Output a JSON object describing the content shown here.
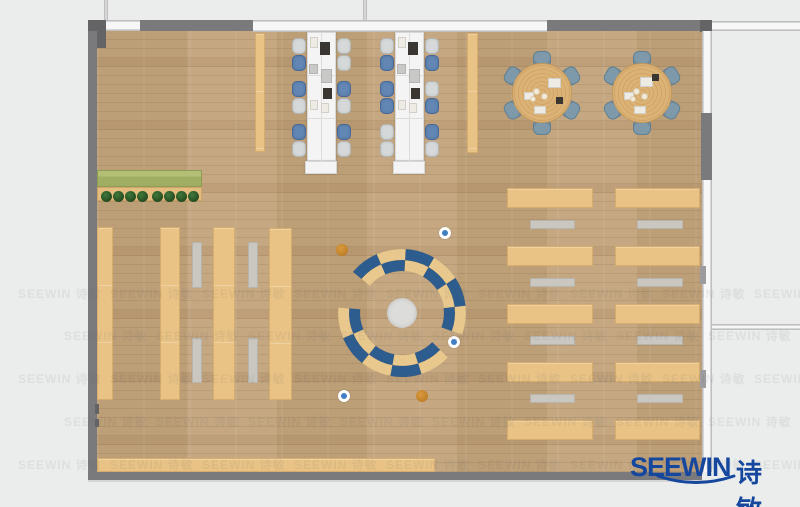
{
  "logo": {
    "en": "SEEWIN",
    "cn": "诗敏",
    "color": "#15479e"
  },
  "watermark": {
    "text": "SEEWIN 诗敏",
    "rows": [
      285,
      327,
      370,
      413,
      456
    ],
    "x_starts": [
      18,
      64
    ],
    "dx": 92,
    "x_max": 770
  },
  "palette": {
    "background": "#ebecec",
    "wall": "#7a7a7c",
    "wall_dark": "#646467",
    "floor_wood": "#c2a37b",
    "desk_white": "#f3f4f3",
    "chair_blue": "#6287b5",
    "chair_gray": "#d6d9d9",
    "seat_slate": "#7e99aa",
    "shelf_tan": "#e8c385",
    "bench_gray": "#cac7c1",
    "planter_green": "#9fae63",
    "tree_green": "#2f5c2f",
    "arc_blue": "#2d5d8e",
    "arc_tan": "#e8c88d",
    "stool_blue": "#3f80c2",
    "stool_orange": "#c8872b",
    "hub_gray": "#dcdcda"
  },
  "plan": {
    "canvas": {
      "w": 800,
      "h": 507
    },
    "rects": [
      {
        "x": 97,
        "y": 31,
        "w": 605,
        "h": 441,
        "t": "floor",
        "n": "wood-floor"
      },
      {
        "x": 255,
        "y": 33,
        "w": 10,
        "h": 119,
        "t": "shelf",
        "n": "side-strip-left"
      },
      {
        "x": 467,
        "y": 33,
        "w": 11,
        "h": 120,
        "t": "shelf",
        "n": "side-strip-right"
      },
      {
        "x": 307,
        "y": 32,
        "w": 29,
        "h": 129,
        "t": "desk",
        "n": "desk-bench-a"
      },
      {
        "x": 395,
        "y": 32,
        "w": 29,
        "h": 129,
        "t": "desk",
        "n": "desk-bench-b"
      },
      {
        "x": 305,
        "y": 161,
        "w": 32,
        "h": 13,
        "t": "desk",
        "n": "desk-return-a"
      },
      {
        "x": 393,
        "y": 161,
        "w": 32,
        "h": 13,
        "t": "desk",
        "n": "desk-return-b"
      },
      {
        "x": 321,
        "y": 32,
        "w": 1,
        "h": 129,
        "t": "desk-line",
        "n": "desk-divider"
      },
      {
        "x": 409,
        "y": 32,
        "w": 1,
        "h": 129,
        "t": "desk-line",
        "n": "desk-divider"
      },
      {
        "x": 307,
        "y": 75,
        "w": 29,
        "h": 1,
        "t": "desk-line",
        "n": "desk-divider"
      },
      {
        "x": 307,
        "y": 118,
        "w": 29,
        "h": 1,
        "t": "desk-line",
        "n": "desk-divider"
      },
      {
        "x": 395,
        "y": 75,
        "w": 29,
        "h": 1,
        "t": "desk-line",
        "n": "desk-divider"
      },
      {
        "x": 395,
        "y": 118,
        "w": 29,
        "h": 1,
        "t": "desk-line",
        "n": "desk-divider"
      },
      {
        "x": 310,
        "y": 37,
        "w": 8,
        "h": 11,
        "t": "paper",
        "n": "paper"
      },
      {
        "x": 320,
        "y": 42,
        "w": 10,
        "h": 13,
        "t": "laptop",
        "n": "laptop"
      },
      {
        "x": 309,
        "y": 64,
        "w": 9,
        "h": 10,
        "t": "panel",
        "n": "desk-panel"
      },
      {
        "x": 321,
        "y": 69,
        "w": 11,
        "h": 14,
        "t": "panel",
        "n": "desk-panel"
      },
      {
        "x": 323,
        "y": 88,
        "w": 9,
        "h": 11,
        "t": "laptop",
        "n": "laptop"
      },
      {
        "x": 310,
        "y": 100,
        "w": 8,
        "h": 10,
        "t": "paper",
        "n": "paper"
      },
      {
        "x": 321,
        "y": 103,
        "w": 8,
        "h": 10,
        "t": "paper",
        "n": "paper"
      },
      {
        "x": 398,
        "y": 37,
        "w": 8,
        "h": 11,
        "t": "paper",
        "n": "paper"
      },
      {
        "x": 408,
        "y": 42,
        "w": 10,
        "h": 13,
        "t": "laptop",
        "n": "laptop"
      },
      {
        "x": 397,
        "y": 64,
        "w": 9,
        "h": 10,
        "t": "panel",
        "n": "desk-panel"
      },
      {
        "x": 409,
        "y": 69,
        "w": 11,
        "h": 14,
        "t": "panel",
        "n": "desk-panel"
      },
      {
        "x": 411,
        "y": 88,
        "w": 9,
        "h": 11,
        "t": "laptop",
        "n": "laptop"
      },
      {
        "x": 398,
        "y": 100,
        "w": 8,
        "h": 10,
        "t": "paper",
        "n": "paper"
      },
      {
        "x": 409,
        "y": 103,
        "w": 8,
        "h": 10,
        "t": "paper",
        "n": "paper"
      },
      {
        "x": 97,
        "y": 170,
        "w": 105,
        "h": 17,
        "t": "planter",
        "n": "hedge-planter"
      },
      {
        "x": 97,
        "y": 187,
        "w": 105,
        "h": 14,
        "t": "planter-base",
        "n": "hedge-base"
      },
      {
        "x": 97,
        "y": 227,
        "w": 16,
        "h": 173,
        "t": "shelf",
        "n": "bookshelf-column-1"
      },
      {
        "x": 160,
        "y": 227,
        "w": 20,
        "h": 173,
        "t": "shelf",
        "n": "bookshelf-column-2"
      },
      {
        "x": 213,
        "y": 227,
        "w": 22,
        "h": 173,
        "t": "shelf",
        "n": "bookshelf-column-3"
      },
      {
        "x": 269,
        "y": 228,
        "w": 23,
        "h": 172,
        "t": "shelf",
        "n": "bookshelf-column-4"
      },
      {
        "x": 192,
        "y": 242,
        "w": 10,
        "h": 46,
        "t": "bench",
        "n": "bench-strip"
      },
      {
        "x": 192,
        "y": 338,
        "w": 10,
        "h": 45,
        "t": "bench",
        "n": "bench-strip"
      },
      {
        "x": 248,
        "y": 242,
        "w": 10,
        "h": 46,
        "t": "bench",
        "n": "bench-strip"
      },
      {
        "x": 248,
        "y": 338,
        "w": 10,
        "h": 45,
        "t": "bench",
        "n": "bench-strip"
      },
      {
        "x": 507,
        "y": 188,
        "w": 86,
        "h": 20,
        "t": "shelf",
        "n": "reading-row"
      },
      {
        "x": 507,
        "y": 246,
        "w": 86,
        "h": 20,
        "t": "shelf",
        "n": "reading-row"
      },
      {
        "x": 507,
        "y": 304,
        "w": 86,
        "h": 20,
        "t": "shelf",
        "n": "reading-row"
      },
      {
        "x": 507,
        "y": 362,
        "w": 86,
        "h": 20,
        "t": "shelf",
        "n": "reading-row"
      },
      {
        "x": 507,
        "y": 420,
        "w": 86,
        "h": 20,
        "t": "shelf",
        "n": "reading-row"
      },
      {
        "x": 615,
        "y": 188,
        "w": 85,
        "h": 20,
        "t": "shelf",
        "n": "reading-row"
      },
      {
        "x": 615,
        "y": 246,
        "w": 85,
        "h": 20,
        "t": "shelf",
        "n": "reading-row"
      },
      {
        "x": 615,
        "y": 304,
        "w": 85,
        "h": 20,
        "t": "shelf",
        "n": "reading-row"
      },
      {
        "x": 615,
        "y": 362,
        "w": 85,
        "h": 20,
        "t": "shelf",
        "n": "reading-row"
      },
      {
        "x": 615,
        "y": 420,
        "w": 85,
        "h": 20,
        "t": "shelf",
        "n": "reading-row"
      },
      {
        "x": 530,
        "y": 220,
        "w": 45,
        "h": 9,
        "t": "bench",
        "n": "bench-strip"
      },
      {
        "x": 530,
        "y": 278,
        "w": 45,
        "h": 9,
        "t": "bench",
        "n": "bench-strip"
      },
      {
        "x": 530,
        "y": 336,
        "w": 45,
        "h": 9,
        "t": "bench",
        "n": "bench-strip"
      },
      {
        "x": 530,
        "y": 394,
        "w": 45,
        "h": 9,
        "t": "bench",
        "n": "bench-strip"
      },
      {
        "x": 637,
        "y": 220,
        "w": 46,
        "h": 9,
        "t": "bench",
        "n": "bench-strip"
      },
      {
        "x": 637,
        "y": 278,
        "w": 46,
        "h": 9,
        "t": "bench",
        "n": "bench-strip"
      },
      {
        "x": 637,
        "y": 336,
        "w": 46,
        "h": 9,
        "t": "bench",
        "n": "bench-strip"
      },
      {
        "x": 637,
        "y": 394,
        "w": 46,
        "h": 9,
        "t": "bench",
        "n": "bench-strip"
      },
      {
        "x": 97,
        "y": 458,
        "w": 338,
        "h": 14,
        "t": "shelf",
        "n": "bottom-counter"
      },
      {
        "x": 548,
        "y": 78,
        "w": 13,
        "h": 10,
        "t": "paper",
        "n": "paper"
      },
      {
        "x": 524,
        "y": 92,
        "w": 10,
        "h": 8,
        "t": "paper",
        "n": "paper"
      },
      {
        "x": 534,
        "y": 106,
        "w": 12,
        "h": 8,
        "t": "paper",
        "n": "paper"
      },
      {
        "x": 556,
        "y": 97,
        "w": 7,
        "h": 7,
        "t": "laptop",
        "n": "tablet"
      },
      {
        "x": 640,
        "y": 77,
        "w": 13,
        "h": 10,
        "t": "paper",
        "n": "paper"
      },
      {
        "x": 624,
        "y": 92,
        "w": 10,
        "h": 8,
        "t": "paper",
        "n": "paper"
      },
      {
        "x": 634,
        "y": 106,
        "w": 12,
        "h": 8,
        "t": "paper",
        "n": "paper"
      },
      {
        "x": 652,
        "y": 74,
        "w": 7,
        "h": 7,
        "t": "laptop",
        "n": "tablet"
      },
      {
        "x": 104,
        "y": 0,
        "w": 4,
        "h": 21,
        "t": "window-v",
        "n": "exterior-wall-line"
      },
      {
        "x": 363,
        "y": 0,
        "w": 4,
        "h": 21,
        "t": "window-v",
        "n": "exterior-wall-line"
      },
      {
        "x": 88,
        "y": 20,
        "w": 18,
        "h": 28,
        "t": "wall-dark",
        "n": "corner-column-nw"
      },
      {
        "x": 106,
        "y": 20,
        "w": 34,
        "h": 11,
        "t": "window-h",
        "n": "window-top"
      },
      {
        "x": 140,
        "y": 20,
        "w": 113,
        "h": 11,
        "t": "wall",
        "n": "wall-top-left"
      },
      {
        "x": 253,
        "y": 20,
        "w": 294,
        "h": 12,
        "t": "window-h",
        "n": "window-top-main"
      },
      {
        "x": 547,
        "y": 20,
        "w": 155,
        "h": 11,
        "t": "wall",
        "n": "wall-top-right"
      },
      {
        "x": 700,
        "y": 20,
        "w": 12,
        "h": 12,
        "t": "wall-dark",
        "n": "corner-column-ne"
      },
      {
        "x": 712,
        "y": 21,
        "w": 88,
        "h": 10,
        "t": "window-h",
        "n": "exterior-window-band"
      },
      {
        "x": 88,
        "y": 31,
        "w": 9,
        "h": 449,
        "t": "wall",
        "n": "wall-left"
      },
      {
        "x": 95,
        "y": 404,
        "w": 4,
        "h": 10,
        "t": "wall-dark",
        "n": "wall-detail"
      },
      {
        "x": 95,
        "y": 419,
        "w": 4,
        "h": 8,
        "t": "wall-dark",
        "n": "wall-detail"
      },
      {
        "x": 88,
        "y": 472,
        "w": 614,
        "h": 8,
        "t": "wall",
        "n": "wall-bottom"
      },
      {
        "x": 88,
        "y": 480,
        "w": 624,
        "h": 2,
        "t": "window-edge",
        "n": "wall-shadow"
      },
      {
        "x": 702,
        "y": 31,
        "w": 10,
        "h": 441,
        "t": "window-v",
        "n": "window-wall-right"
      },
      {
        "x": 701,
        "y": 113,
        "w": 11,
        "h": 67,
        "t": "wall",
        "n": "wall-right-block"
      },
      {
        "x": 700,
        "y": 266,
        "w": 6,
        "h": 18,
        "t": "wall-light",
        "n": "window-mullion"
      },
      {
        "x": 700,
        "y": 370,
        "w": 6,
        "h": 18,
        "t": "wall-light",
        "n": "window-mullion"
      },
      {
        "x": 712,
        "y": 324,
        "w": 88,
        "h": 6,
        "t": "window-h",
        "n": "exterior-wall-line-right"
      }
    ],
    "chairs": [
      {
        "cx": 299,
        "cy": 46,
        "c": "gray"
      },
      {
        "cx": 299,
        "cy": 63,
        "c": "blue"
      },
      {
        "cx": 299,
        "cy": 89,
        "c": "blue"
      },
      {
        "cx": 299,
        "cy": 106,
        "c": "gray"
      },
      {
        "cx": 299,
        "cy": 132,
        "c": "blue"
      },
      {
        "cx": 299,
        "cy": 149,
        "c": "gray"
      },
      {
        "cx": 344,
        "cy": 46,
        "c": "gray"
      },
      {
        "cx": 344,
        "cy": 63,
        "c": "gray"
      },
      {
        "cx": 344,
        "cy": 89,
        "c": "blue"
      },
      {
        "cx": 344,
        "cy": 106,
        "c": "gray"
      },
      {
        "cx": 344,
        "cy": 132,
        "c": "blue"
      },
      {
        "cx": 344,
        "cy": 149,
        "c": "gray"
      },
      {
        "cx": 387,
        "cy": 46,
        "c": "gray"
      },
      {
        "cx": 387,
        "cy": 63,
        "c": "blue"
      },
      {
        "cx": 387,
        "cy": 89,
        "c": "blue"
      },
      {
        "cx": 387,
        "cy": 106,
        "c": "blue"
      },
      {
        "cx": 387,
        "cy": 132,
        "c": "gray"
      },
      {
        "cx": 387,
        "cy": 149,
        "c": "gray"
      },
      {
        "cx": 432,
        "cy": 46,
        "c": "gray"
      },
      {
        "cx": 432,
        "cy": 63,
        "c": "blue"
      },
      {
        "cx": 432,
        "cy": 89,
        "c": "gray"
      },
      {
        "cx": 432,
        "cy": 106,
        "c": "blue"
      },
      {
        "cx": 432,
        "cy": 132,
        "c": "blue"
      },
      {
        "cx": 432,
        "cy": 149,
        "c": "gray"
      }
    ],
    "tables": [
      {
        "cx": 542,
        "cy": 93,
        "r": 30,
        "seat_r": 34,
        "seat_angles": [
          30,
          90,
          150,
          210,
          270,
          330
        ]
      },
      {
        "cx": 642,
        "cy": 93,
        "r": 30,
        "seat_r": 34,
        "seat_angles": [
          30,
          90,
          150,
          210,
          270,
          330
        ]
      }
    ],
    "circles": [
      {
        "cx": 106,
        "cy": 196,
        "r": 5.5,
        "t": "tree"
      },
      {
        "cx": 118,
        "cy": 196,
        "r": 5.5,
        "t": "tree"
      },
      {
        "cx": 130,
        "cy": 196,
        "r": 5.5,
        "t": "tree"
      },
      {
        "cx": 142,
        "cy": 196,
        "r": 5.5,
        "t": "tree"
      },
      {
        "cx": 157,
        "cy": 196,
        "r": 5.5,
        "t": "tree"
      },
      {
        "cx": 169,
        "cy": 196,
        "r": 5.5,
        "t": "tree"
      },
      {
        "cx": 181,
        "cy": 196,
        "r": 5.5,
        "t": "tree"
      },
      {
        "cx": 193,
        "cy": 196,
        "r": 5.5,
        "t": "tree"
      },
      {
        "cx": 536,
        "cy": 91,
        "r": 3.5,
        "t": "plate"
      },
      {
        "cx": 544,
        "cy": 96,
        "r": 3.5,
        "t": "plate"
      },
      {
        "cx": 533,
        "cy": 99,
        "r": 3,
        "t": "plate"
      },
      {
        "cx": 636,
        "cy": 91,
        "r": 3.5,
        "t": "plate"
      },
      {
        "cx": 644,
        "cy": 96,
        "r": 3.5,
        "t": "plate"
      },
      {
        "cx": 633,
        "cy": 99,
        "r": 3,
        "t": "plate"
      },
      {
        "cx": 402,
        "cy": 313,
        "r": 15,
        "t": "hub"
      },
      {
        "cx": 445,
        "cy": 233,
        "r": 6,
        "t": "stool-blue"
      },
      {
        "cx": 454,
        "cy": 342,
        "r": 6,
        "t": "stool-blue"
      },
      {
        "cx": 344,
        "cy": 396,
        "r": 6,
        "t": "stool-blue"
      },
      {
        "cx": 342,
        "cy": 250,
        "r": 6,
        "t": "stool-orange"
      },
      {
        "cx": 422,
        "cy": 396,
        "r": 6,
        "t": "stool-orange"
      }
    ],
    "arcs": {
      "cx": 402,
      "cy": 313,
      "r_inner": 42,
      "r_mid": 53,
      "r_outer": 64,
      "blue": "#2d5d8e",
      "tan": "#e8c88d",
      "spans": [
        {
          "a0": -20,
          "a1": 140,
          "n": 6,
          "phase": 0
        },
        {
          "a0": 175,
          "a1": 316,
          "n": 5,
          "phase": 0
        }
      ]
    }
  }
}
